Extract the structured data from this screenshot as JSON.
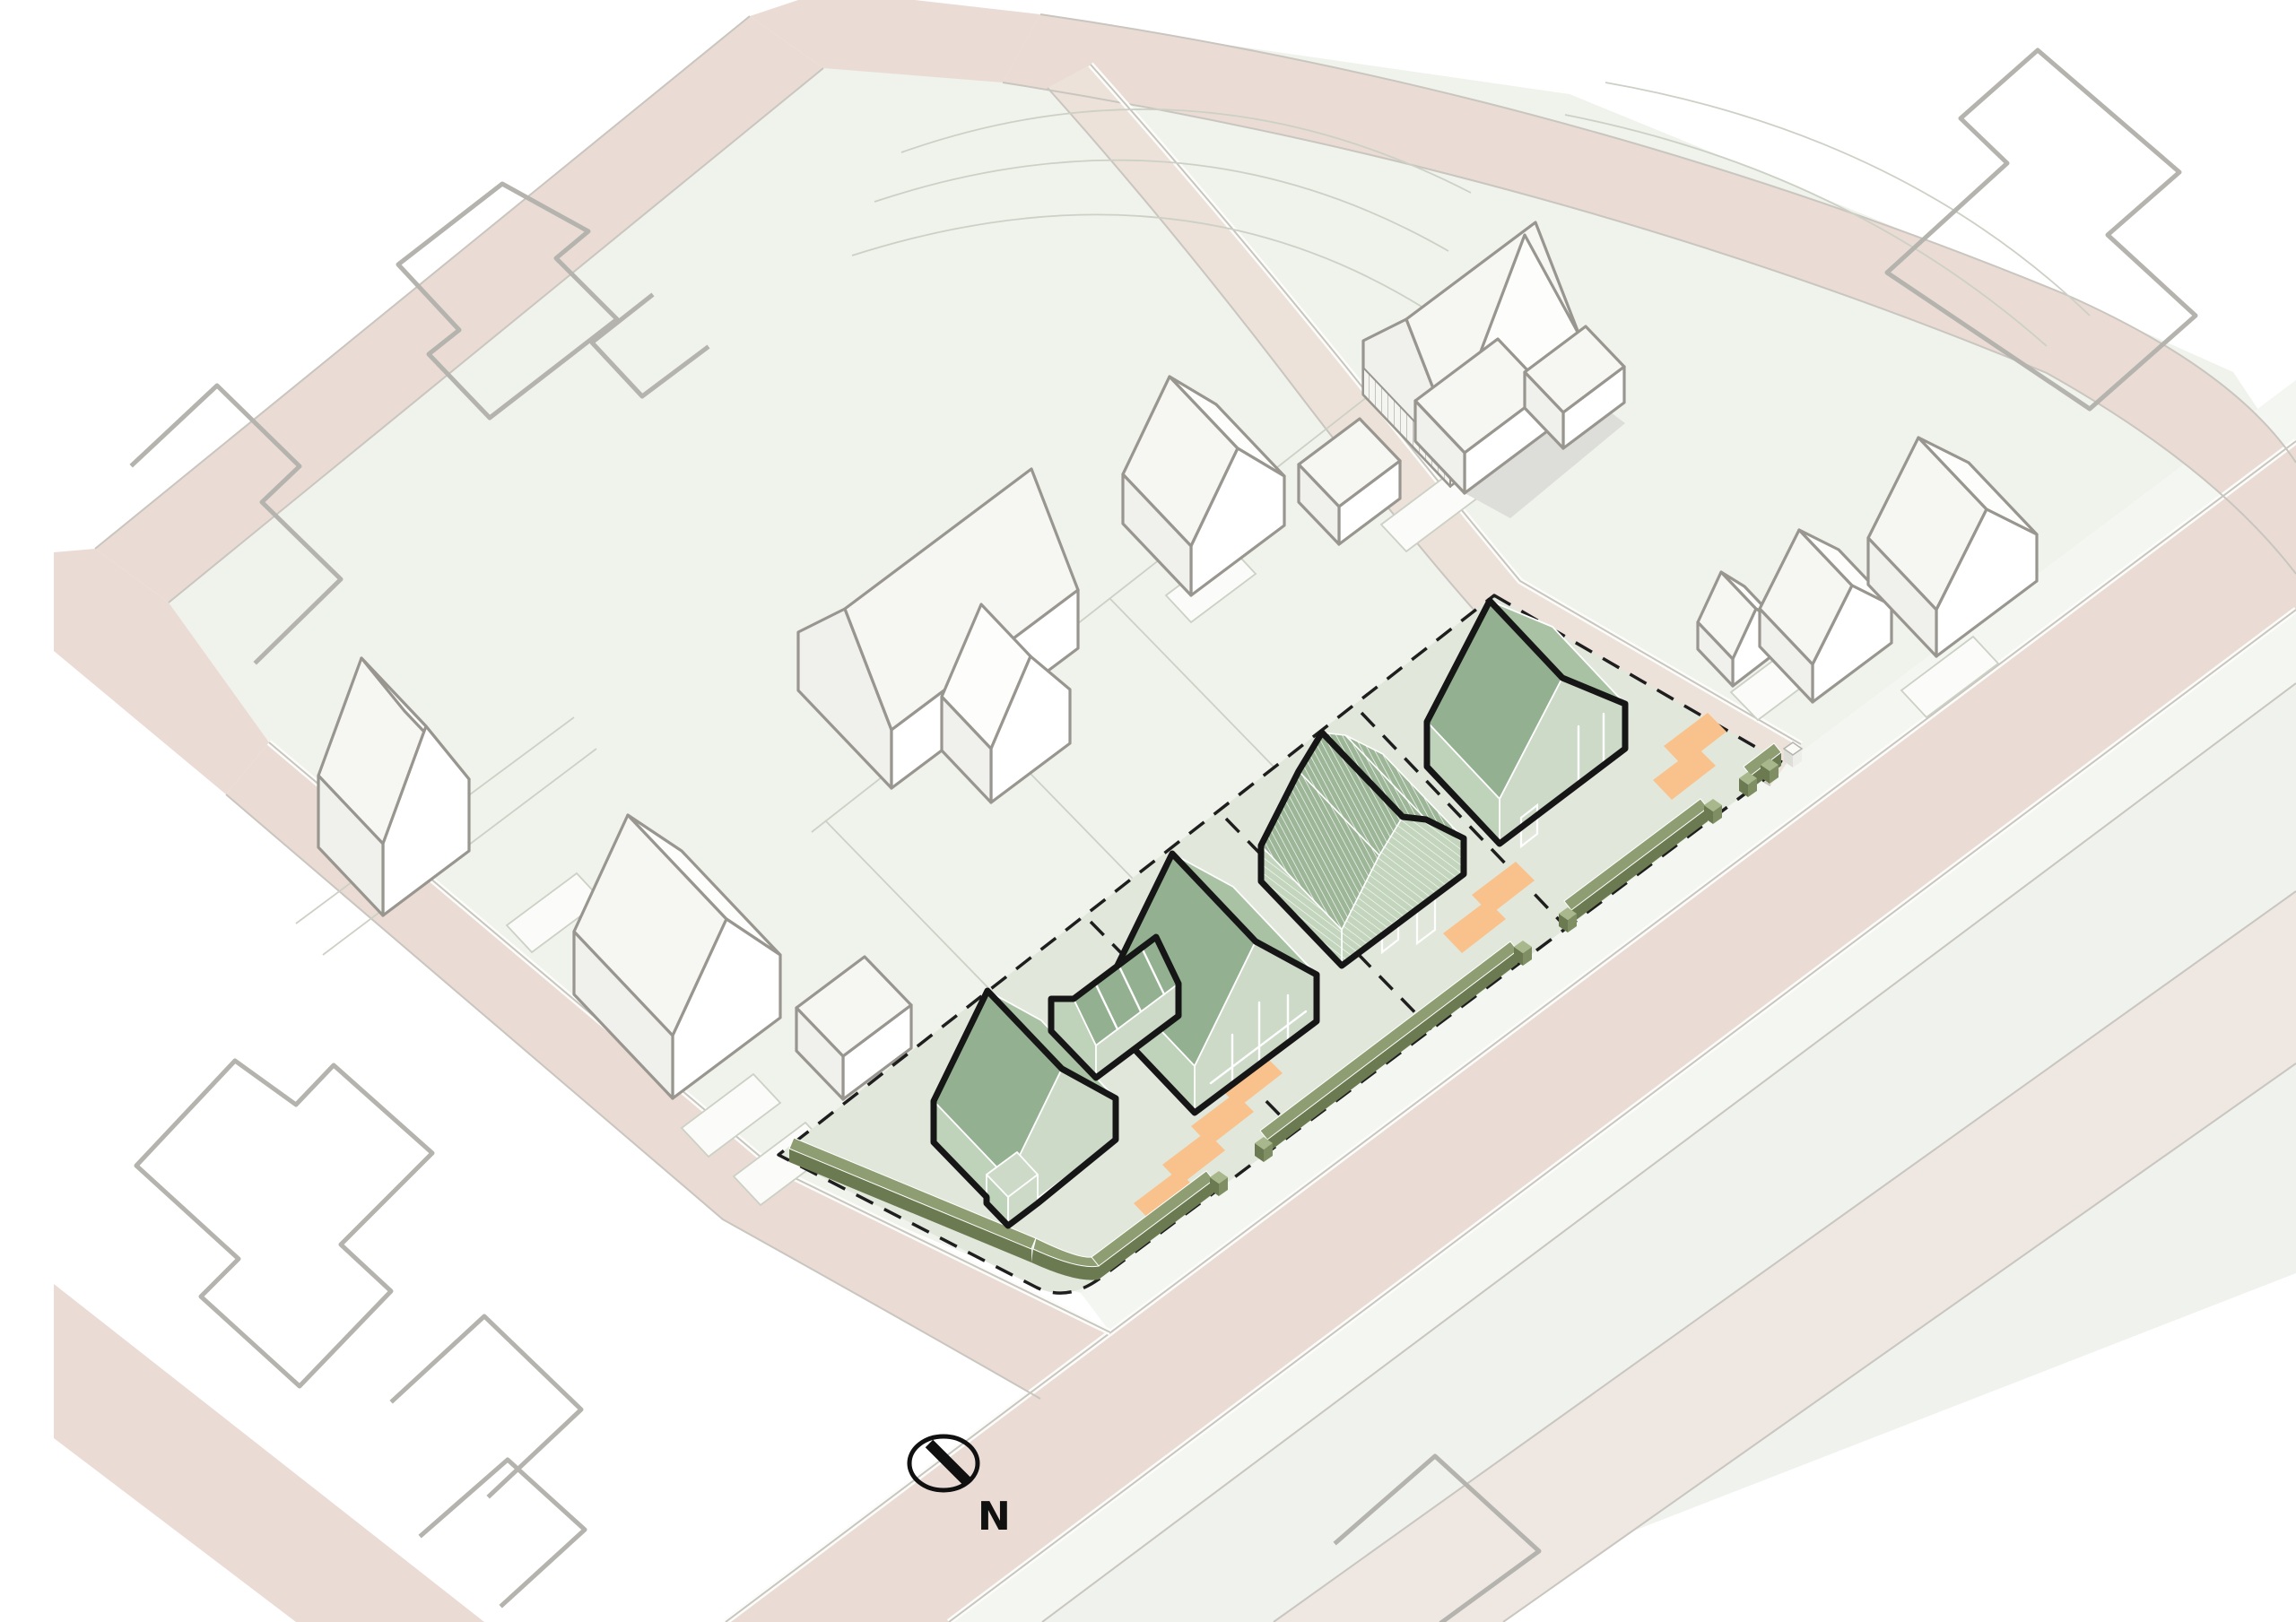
{
  "meta": {
    "type": "axonometric-site-plan",
    "view": "isometric aerial",
    "description": "Site plan diagram with four proposed green houses on a parcel, surrounding white context buildings, roads and a north arrow"
  },
  "compass": {
    "label": "N"
  },
  "site": {
    "name": "development-parcel",
    "plots": 4,
    "boundary_style": "dashed",
    "proposed_houses": [
      {
        "id": "house-1",
        "position": "south-west",
        "form": "gable house with entrance porch"
      },
      {
        "id": "house-2",
        "position": "mid-south",
        "form": "gable house with attached garage wing and porch frame"
      },
      {
        "id": "house-3",
        "position": "mid-north",
        "form": "gambrel barn house with clad roof and siding"
      },
      {
        "id": "house-4",
        "position": "north-east",
        "form": "gable house"
      }
    ],
    "parking_pads": 8,
    "hedge_segments": 6,
    "gate_posts": 8
  },
  "context": {
    "white_buildings": 10,
    "footprint_outlines": 8,
    "roads": [
      "main street south-east",
      "minor street south-west",
      "upper-left road",
      "upper-right road",
      "access lane"
    ]
  },
  "palette": {
    "ground": "#f0f2ec",
    "groundOuter": "#f0f2ed",
    "site": "#e1e8db",
    "roadPink": "#eadcd4",
    "roadPale": "#efe8e2",
    "sidewalk": "#f4f6f1",
    "laneFill": "#ece2da",
    "roofMain": "#93b090",
    "roofLight": "#a9c2a4",
    "wallFront": "#ccdac7",
    "wallSide": "#bfd2ba",
    "barnRoof": "#9cb697",
    "barnWall": "#c3d5bd",
    "hedgeTop": "#8e9d72",
    "hedgeSide": "#6c7a51",
    "parking": "#f9c28c",
    "outline": "#161616",
    "ctxStroke": "#98968f",
    "footprintStroke": "#b5b3ae",
    "thinLine": "#ccd0c5",
    "dash": "#1e1e1e"
  }
}
